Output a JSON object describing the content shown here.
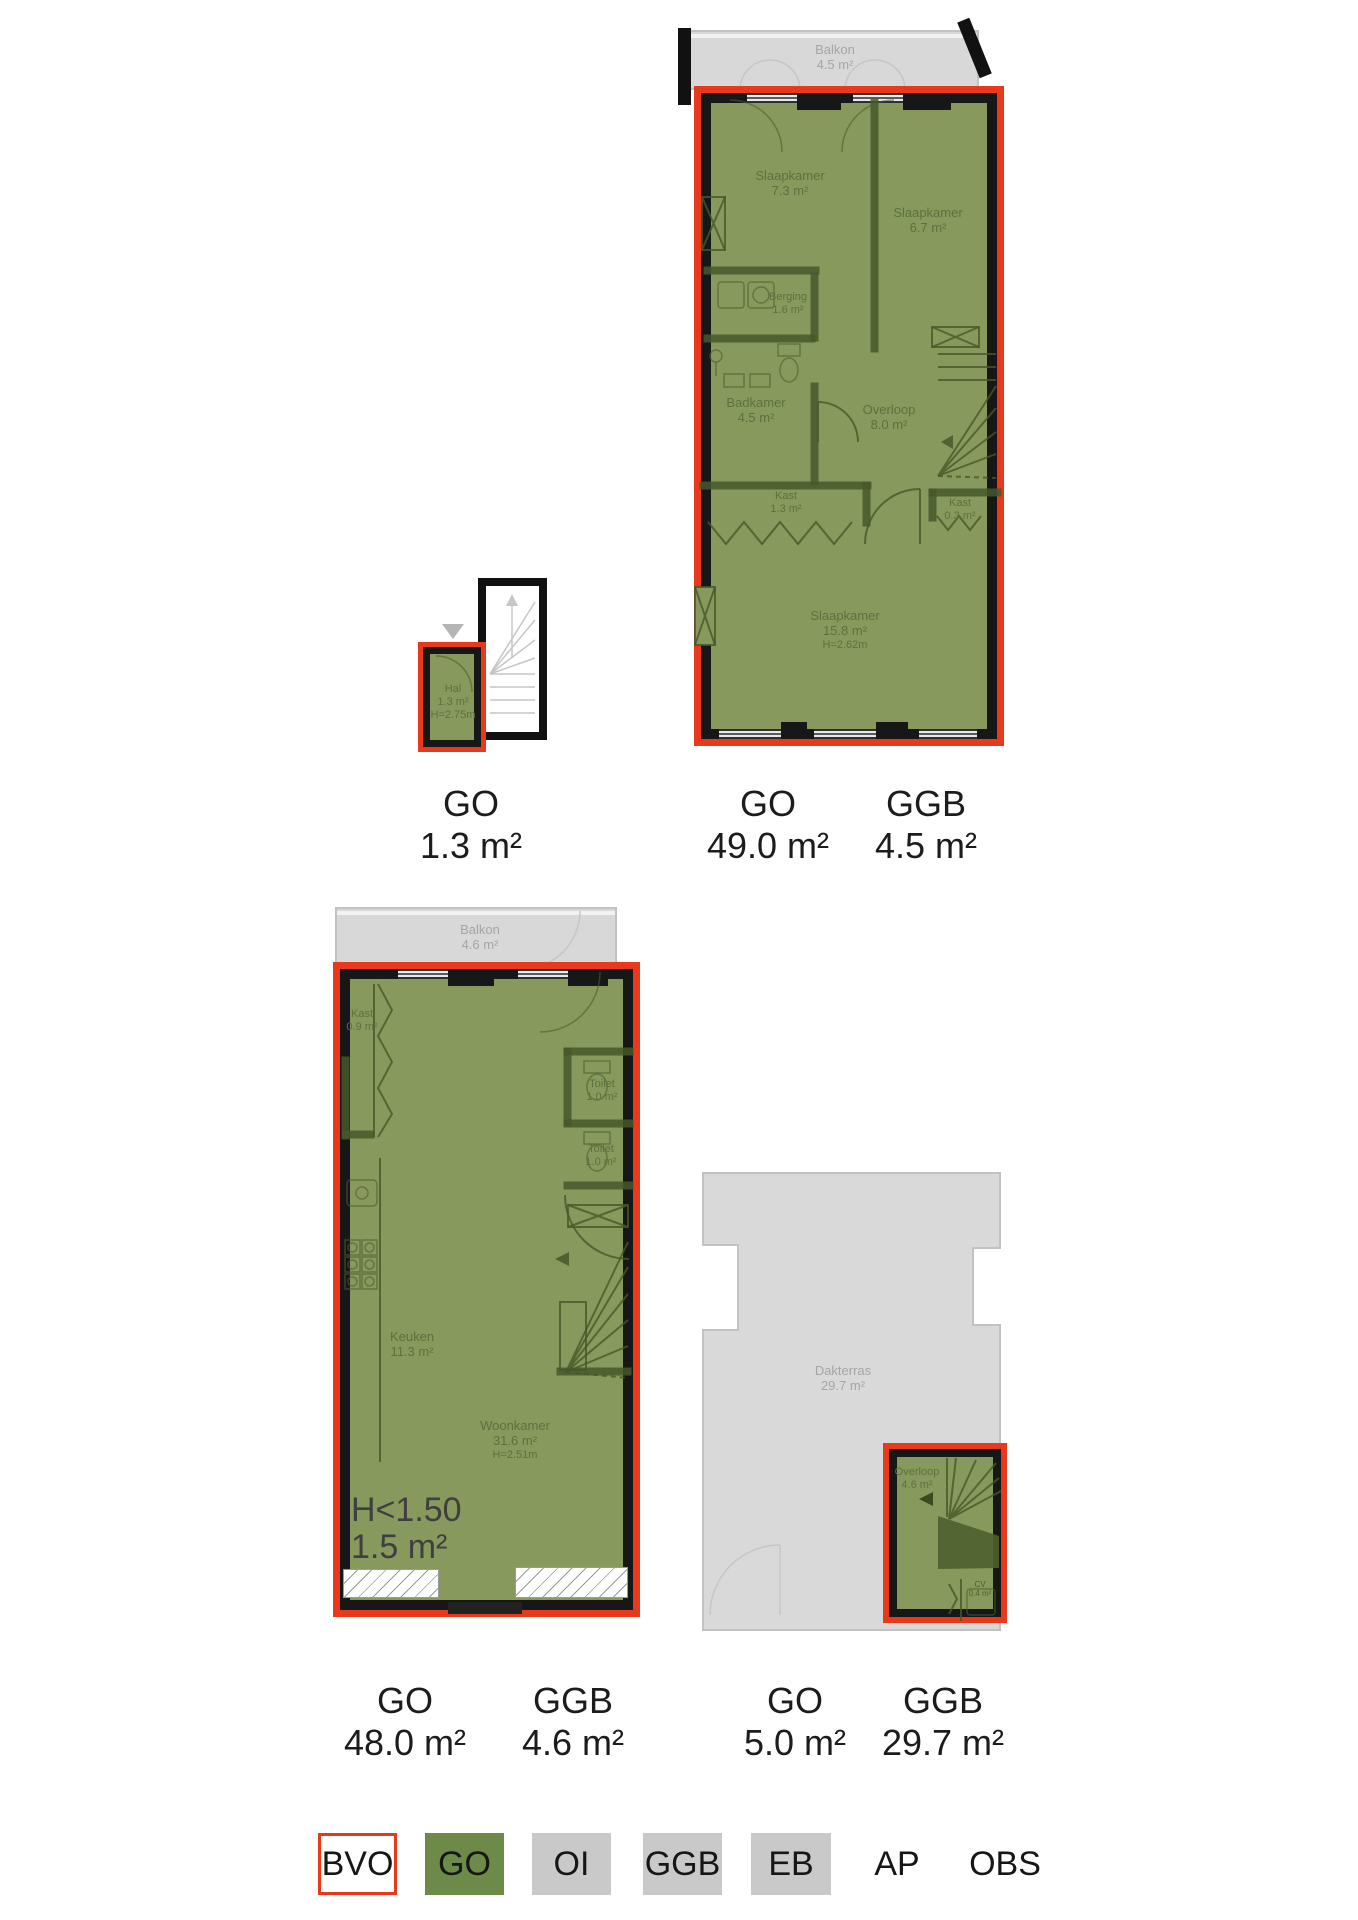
{
  "colors": {
    "go_green": "#6d8a49",
    "overlay_green": "#87995c",
    "bvo_red": "#e8391d",
    "ggb_gray": "#c9c9c9",
    "wall_black": "#171717",
    "room_text_green": "#5d7140",
    "outdoor_gray": "#d8d8d8"
  },
  "plans": {
    "hal": {
      "rooms": [
        {
          "name": "Hal",
          "area": "1.3 m²",
          "height": "H=2.75m"
        }
      ],
      "metrics": [
        {
          "code": "GO",
          "value": "1.3 m²"
        }
      ]
    },
    "upper_floor": {
      "balcony": {
        "name": "Balkon",
        "area": "4.5 m²"
      },
      "rooms": [
        {
          "name": "Slaapkamer",
          "area": "7.3 m²"
        },
        {
          "name": "Slaapkamer",
          "area": "6.7 m²"
        },
        {
          "name": "Berging",
          "area": "1.6 m²"
        },
        {
          "name": "Badkamer",
          "area": "4.5 m²"
        },
        {
          "name": "Overloop",
          "area": "8.0 m²"
        },
        {
          "name": "Kast",
          "area": "1.3 m²"
        },
        {
          "name": "Kast",
          "area": "0.3 m²"
        },
        {
          "name": "Slaapkamer",
          "area": "15.8 m²",
          "height": "H=2.62m"
        }
      ],
      "metrics": [
        {
          "code": "GO",
          "value": "49.0 m²"
        },
        {
          "code": "GGB",
          "value": "4.5 m²"
        }
      ]
    },
    "ground_floor": {
      "balcony": {
        "name": "Balkon",
        "area": "4.6 m²"
      },
      "rooms": [
        {
          "name": "Kast",
          "area": "0.9 m²"
        },
        {
          "name": "Toilet",
          "area": "1.0 m²"
        },
        {
          "name": "Toilet",
          "area": "1.0 m²"
        },
        {
          "name": "Keuken",
          "area": "11.3 m²"
        },
        {
          "name": "Woonkamer",
          "area": "31.6 m²",
          "height": "H=2.51m"
        }
      ],
      "low_height_note": {
        "line1": "H<1.50",
        "line2": "1.5 m²"
      },
      "metrics": [
        {
          "code": "GO",
          "value": "48.0 m²"
        },
        {
          "code": "GGB",
          "value": "4.6 m²"
        }
      ]
    },
    "roof": {
      "terrace": {
        "name": "Dakterras",
        "area": "29.7 m²"
      },
      "rooms": [
        {
          "name": "Overloop",
          "area": "4.6 m²"
        },
        {
          "name": "CV",
          "area": "0.4 m²"
        }
      ],
      "metrics": [
        {
          "code": "GO",
          "value": "5.0 m²"
        },
        {
          "code": "GGB",
          "value": "29.7 m²"
        }
      ]
    }
  },
  "legend": {
    "items": [
      {
        "label": "BVO"
      },
      {
        "label": "GO"
      },
      {
        "label": "OI"
      },
      {
        "label": "GGB"
      },
      {
        "label": "EB"
      },
      {
        "label": "AP"
      },
      {
        "label": "OBS"
      }
    ]
  }
}
